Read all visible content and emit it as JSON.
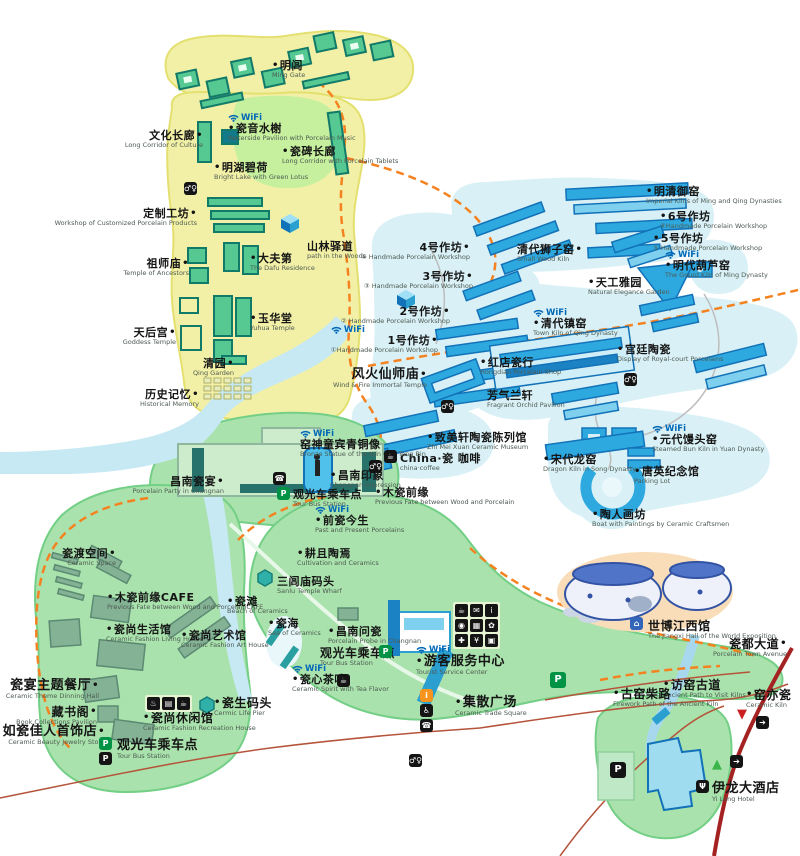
{
  "wifi_text": "WiFi",
  "palette": {
    "yellow_zone": "#f2f0a6",
    "yellow_border": "#e4e070",
    "blue_zone": "#d9f1f6",
    "blue_building": "#2ea9e0",
    "blue_dark": "#1272b8",
    "green_zone": "#a9e2ac",
    "green_border": "#74cf86",
    "sage_building": "#84b295",
    "teal_building": "#56c892",
    "teal_dark": "#127a68",
    "river": "#c6e9f4",
    "orange_path": "#f58220",
    "red_road": "#b5543b",
    "avenue_red": "#a42222",
    "wifi_blue": "#0068b7",
    "label_dark": "#151515"
  },
  "markers": [
    {
      "n": "ming-gate",
      "zh": "明闾",
      "en": "Ming Gate",
      "x": 272,
      "y": 60,
      "d": "l"
    },
    {
      "n": "ciyin-shuixie",
      "zh": "瓷音水榭",
      "en": "Waterside Pavilion with Porcelain Music",
      "x": 228,
      "y": 113,
      "d": "l",
      "w": true
    },
    {
      "n": "wenhua-changlang",
      "zh": "文化长廊",
      "en": "Long Corridor of Culture",
      "x": 203,
      "y": 130,
      "d": "r",
      "a": "r"
    },
    {
      "n": "cibei-changlang",
      "zh": "瓷碑长廊",
      "en": "Long Corridor with Porcelain Tablets",
      "x": 282,
      "y": 146,
      "d": "l"
    },
    {
      "n": "minghu-bihe",
      "zh": "明湖碧荷",
      "en": "Bright Lake with Green Lotus",
      "x": 214,
      "y": 162,
      "d": "l"
    },
    {
      "n": "dingzhi-gongfang",
      "zh": "定制工坊",
      "en": "Workshop of Customized Porcelain Products",
      "x": 197,
      "y": 208,
      "d": "r",
      "a": "r"
    },
    {
      "n": "zushi-miao",
      "zh": "祖师庙",
      "en": "Temple of Ancestors",
      "x": 189,
      "y": 258,
      "d": "r",
      "a": "r"
    },
    {
      "n": "dafu-di",
      "zh": "大夫第",
      "en": "The Dafu Residence",
      "x": 250,
      "y": 253,
      "d": "l"
    },
    {
      "n": "shanlin-yidao",
      "zh": "山林驿道",
      "en": "path in the Woods",
      "x": 307,
      "y": 241
    },
    {
      "n": "yuhua-tang",
      "zh": "玉华堂",
      "en": "Yuhua Temple",
      "x": 250,
      "y": 313,
      "d": "l"
    },
    {
      "n": "tianhou-gong",
      "zh": "天后宫",
      "en": "Goddess Temple",
      "x": 176,
      "y": 327,
      "d": "r",
      "a": "r"
    },
    {
      "n": "qing-yuan",
      "zh": "清园",
      "en": "Qing Garden",
      "x": 234,
      "y": 358,
      "d": "r",
      "a": "r"
    },
    {
      "n": "lishi-jiyi",
      "zh": "历史记忆",
      "en": "Historical Memory",
      "x": 199,
      "y": 389,
      "d": "r",
      "a": "r"
    },
    {
      "n": "mingqing-yuyao",
      "zh": "明清御窑",
      "en": "Imperial Kilns of Ming and Qing Dynasties",
      "x": 646,
      "y": 186,
      "d": "l"
    },
    {
      "n": "workshop-6",
      "zh": "6号作坊",
      "en": "⑥Handmade Porcelain Workshop",
      "x": 660,
      "y": 211,
      "d": "l"
    },
    {
      "n": "workshop-5",
      "zh": "5号作坊",
      "en": "⑤ Handmade Porcelain Workshop",
      "x": 653,
      "y": 233,
      "d": "l"
    },
    {
      "n": "mingdai-huluyao",
      "zh": "明代葫芦窑",
      "en": "The Gourd Kiln of Ming Dynasty",
      "x": 665,
      "y": 250,
      "d": "l",
      "w": true
    },
    {
      "n": "workshop-4",
      "zh": "4号作坊",
      "en": "④ Handmade Porcelain Workshop",
      "x": 470,
      "y": 242,
      "d": "r",
      "a": "r"
    },
    {
      "n": "qingdai-shiziyao",
      "zh": "清代狮子窑",
      "en": "Small Wood Kiln",
      "x": 517,
      "y": 244,
      "d": "r"
    },
    {
      "n": "workshop-3",
      "zh": "3号作坊",
      "en": "③ Handmade Porcelain Workshop",
      "x": 473,
      "y": 271,
      "d": "r",
      "a": "r"
    },
    {
      "n": "tiangong-yayuan",
      "zh": "天工雅园",
      "en": "Natural Elegance Garden",
      "x": 588,
      "y": 277,
      "d": "l"
    },
    {
      "n": "workshop-2",
      "zh": "2号作坊",
      "en": "② Handmade Porcelain Workshop",
      "x": 450,
      "y": 306,
      "d": "r",
      "a": "r"
    },
    {
      "n": "workshop-1",
      "zh": "1号作坊",
      "en": "①Handmade Porcelain Workshop",
      "x": 438,
      "y": 325,
      "d": "r",
      "a": "r",
      "w": true
    },
    {
      "n": "qingdai-zhenyao",
      "zh": "清代镇窑",
      "en": "Town Kiln of Qing Dynasty",
      "x": 533,
      "y": 308,
      "d": "l",
      "w": true
    },
    {
      "n": "hongdian-cihang",
      "zh": "红店瓷行",
      "en": "Hongdian Porcelain Shop",
      "x": 480,
      "y": 357,
      "d": "l"
    },
    {
      "n": "gongting-taoci",
      "zh": "宫廷陶瓷",
      "en": "Display of Royal-court Porcelains",
      "x": 617,
      "y": 344,
      "d": "l"
    },
    {
      "n": "fenghuo-xianshimiao",
      "zh": "风火仙师庙",
      "en": "Wind & Fire Immortal Temple",
      "x": 427,
      "y": 368,
      "d": "r",
      "a": "r",
      "fs": 13
    },
    {
      "n": "fangqi-lanxuan",
      "zh": "芳气兰轩",
      "en": "Fragrant Orchid Pavilion",
      "x": 487,
      "y": 390
    },
    {
      "n": "zhimeixuan-museum",
      "zh": "致美轩陶瓷陈列馆",
      "en": "Zhi Mei Xuan Ceramic Museum",
      "x": 427,
      "y": 432,
      "d": "l"
    },
    {
      "n": "china-coffee",
      "zh": "China·瓷 咖啡",
      "en": "china·coffee",
      "x": 400,
      "y": 453
    },
    {
      "n": "muci-qianyuan",
      "zh": "木瓷前缘",
      "en": "Previous Fate between Wood and Porcelain",
      "x": 375,
      "y": 487,
      "d": "l"
    },
    {
      "n": "yuandai-mantouyao",
      "zh": "元代馒头窑",
      "en": "Steamed Bun Kiln in Yuan Dynasty",
      "x": 652,
      "y": 424,
      "d": "l",
      "w": true
    },
    {
      "n": "songdai-longyao",
      "zh": "宋代龙窑",
      "en": "Dragon Kiln in Song Dynasty",
      "x": 543,
      "y": 454,
      "d": "l"
    },
    {
      "n": "tangying-memorial",
      "zh": "唐英纪念馆",
      "en": "Parking Lot",
      "x": 634,
      "y": 466,
      "d": "l"
    },
    {
      "n": "taoren-huafang",
      "zh": "陶人画坊",
      "en": "Boat with Paintings by Ceramic Craftsmen",
      "x": 592,
      "y": 509,
      "d": "l"
    },
    {
      "n": "kiln-god-statue",
      "zh": "窑神童宾青铜像",
      "en": "Bronze Statue of the Kiln God Tong Bin",
      "x": 300,
      "y": 429,
      "w": true
    },
    {
      "n": "changnan-yinxiang",
      "zh": "昌南印象",
      "en": "Changnan Impression",
      "x": 330,
      "y": 470,
      "d": "l"
    },
    {
      "n": "tour-bus-center",
      "zh": "观光车乘车点",
      "en": "Tour Bus Station",
      "x": 293,
      "y": 489
    },
    {
      "n": "changnan-ciyan",
      "zh": "昌南瓷宴",
      "en": "Porcelain Party in Changnan",
      "x": 224,
      "y": 476,
      "d": "r",
      "a": "r"
    },
    {
      "n": "qianci-jinsheng",
      "zh": "前瓷今生",
      "en": "Past and Present Porcelains",
      "x": 315,
      "y": 505,
      "d": "l",
      "w": true
    },
    {
      "n": "gengqie-taoyan",
      "zh": "耕且陶焉",
      "en": "Cultivation and Ceramics",
      "x": 297,
      "y": 548,
      "d": "l"
    },
    {
      "n": "sanlumiao-wharf",
      "zh": "三闾庙码头",
      "en": "Sanlu Temple Wharf",
      "x": 277,
      "y": 576
    },
    {
      "n": "cidu-kongjian",
      "zh": "瓷渡空间",
      "en": "Ceramic Space",
      "x": 116,
      "y": 548,
      "d": "r",
      "a": "r"
    },
    {
      "n": "muci-cafe",
      "zh": "木瓷前缘CAFE",
      "en": "Previous Fate between Wood and PorcelainCAFE",
      "x": 107,
      "y": 592,
      "d": "l"
    },
    {
      "n": "cishang-living",
      "zh": "瓷尚生活馆",
      "en": "Ceramic Fashion Living House",
      "x": 106,
      "y": 624,
      "d": "l"
    },
    {
      "n": "cishang-art",
      "zh": "瓷尚艺术馆",
      "en": "Ceramic Fashion Art House",
      "x": 181,
      "y": 630,
      "d": "l"
    },
    {
      "n": "citan",
      "zh": "瓷滩",
      "en": "Beach of Ceramics",
      "x": 227,
      "y": 596,
      "d": "l"
    },
    {
      "n": "cihai",
      "zh": "瓷海",
      "en": "Sea of Ceramics",
      "x": 268,
      "y": 618,
      "d": "l"
    },
    {
      "n": "changnan-wenci",
      "zh": "昌南问瓷",
      "en": "Porcelain Probe in Changnan",
      "x": 328,
      "y": 626,
      "d": "l"
    },
    {
      "n": "tour-bus-south",
      "zh": "观光车乘车点",
      "en": "Tour Bus Station",
      "x": 320,
      "y": 647,
      "fs": 12
    },
    {
      "n": "cixin-chawei",
      "zh": "瓷心茶味",
      "en": "Ceramic Spirit with Tea Flavor",
      "x": 292,
      "y": 664,
      "d": "l",
      "w": true
    },
    {
      "n": "tourist-service-center",
      "zh": "游客服务中心",
      "en": "Tourist Service Center",
      "x": 416,
      "y": 645,
      "d": "l",
      "w": true,
      "fs": 13
    },
    {
      "n": "jisan-square",
      "zh": "集散广场",
      "en": "Ceramic Trade Square",
      "x": 455,
      "y": 696,
      "d": "l",
      "fs": 13
    },
    {
      "n": "ciyan-restaurant",
      "zh": "瓷宴主题餐厅",
      "en": "Ceramic Theme Dinning Hall",
      "x": 99,
      "y": 679,
      "d": "r",
      "a": "r",
      "fs": 13
    },
    {
      "n": "cangshu-ge",
      "zh": "藏书阁",
      "en": "Book Collections Pavilion",
      "x": 97,
      "y": 706,
      "d": "r",
      "a": "r",
      "fs": 12
    },
    {
      "n": "ruci-jiaren-jewelry",
      "zh": "如瓷佳人首饰店",
      "en": "Ceramic Beauty Jewelry Store",
      "x": 105,
      "y": 725,
      "d": "r",
      "a": "r",
      "fs": 13
    },
    {
      "n": "tour-bus-west",
      "zh": "观光车乘车点",
      "en": "Tour Bus Station",
      "x": 117,
      "y": 739,
      "fs": 13
    },
    {
      "n": "cishang-recreation",
      "zh": "瓷尚休闲馆",
      "en": "Ceramic Fashion Recreation House",
      "x": 143,
      "y": 712,
      "d": "l",
      "fs": 12
    },
    {
      "n": "cisheng-pier",
      "zh": "瓷生码头",
      "en": "Cermic Life Pier",
      "x": 214,
      "y": 697,
      "d": "l",
      "fs": 12
    },
    {
      "n": "shibo-jiangxi-hall",
      "zh": "世博江西馆",
      "en": "The Jiangxi Hall of the World Exposition",
      "x": 648,
      "y": 620,
      "fs": 12
    },
    {
      "n": "cidu-avenue",
      "zh": "瓷都大道",
      "en": "Porcelain Town Avenue",
      "x": 787,
      "y": 638,
      "d": "r",
      "a": "r",
      "fs": 12
    },
    {
      "n": "fangyao-gudao",
      "zh": "访窑古道",
      "en": "Ancient Path to Visit Kilns",
      "x": 663,
      "y": 679,
      "d": "l",
      "fs": 12
    },
    {
      "n": "guyao-chailu",
      "zh": "古窑柴路",
      "en": "Firework Path of the Ancient Kiln",
      "x": 613,
      "y": 688,
      "d": "l",
      "fs": 12
    },
    {
      "n": "yao-yi-ci",
      "zh": "窑亦瓷",
      "en": "Ceramic Kiln",
      "x": 746,
      "y": 689,
      "d": "l",
      "fs": 12
    },
    {
      "n": "yilong-hotel",
      "zh": "伊龙大酒店",
      "en": "Yi Long Hotel",
      "x": 712,
      "y": 782,
      "fs": 13
    }
  ],
  "icon_defs": {
    "wc": {
      "glyph": "♂♀",
      "bg": "#141414",
      "name": "restroom-icon"
    },
    "parking": {
      "glyph": "P",
      "bg": "#009245",
      "name": "parking-icon"
    },
    "parking-dark": {
      "glyph": "P",
      "bg": "#141414",
      "name": "parking-icon"
    },
    "phone": {
      "glyph": "☎",
      "bg": "#141414",
      "name": "telephone-icon"
    },
    "coffee": {
      "glyph": "☕",
      "bg": "#141414",
      "name": "coffee-icon"
    },
    "tea": {
      "glyph": "☕",
      "bg": "#141414",
      "name": "teahouse-icon"
    },
    "info": {
      "glyph": "i",
      "bg": "#f7941d",
      "name": "information-icon"
    },
    "access": {
      "glyph": "♿",
      "bg": "#141414",
      "name": "accessibility-icon"
    },
    "exit": {
      "glyph": "➔",
      "bg": "#141414",
      "name": "exit-icon"
    },
    "restaurant": {
      "glyph": "Ψ",
      "bg": "#141414",
      "name": "restaurant-icon"
    },
    "hall": {
      "glyph": "⌂",
      "bg": "#3366bb",
      "name": "jiangxi-hall-icon"
    },
    "tri-red": {
      "glyph": "▼",
      "bg": "none",
      "fg": "#cc1f1f",
      "name": "entrance-marker-red"
    },
    "tri-green": {
      "glyph": "▲",
      "bg": "none",
      "fg": "#39b54a",
      "name": "entrance-marker-green"
    }
  },
  "icons": [
    {
      "t": "wc",
      "x": 184,
      "y": 182
    },
    {
      "t": "wc",
      "x": 441,
      "y": 400
    },
    {
      "t": "wc",
      "x": 624,
      "y": 373
    },
    {
      "t": "wc",
      "x": 369,
      "y": 460
    },
    {
      "t": "wc",
      "x": 409,
      "y": 754
    },
    {
      "t": "coffee",
      "x": 384,
      "y": 450
    },
    {
      "t": "tea",
      "x": 337,
      "y": 674
    },
    {
      "t": "phone",
      "x": 273,
      "y": 472
    },
    {
      "t": "phone",
      "x": 420,
      "y": 719
    },
    {
      "t": "info",
      "x": 420,
      "y": 689
    },
    {
      "t": "access",
      "x": 420,
      "y": 704
    },
    {
      "t": "parking",
      "x": 277,
      "y": 487
    },
    {
      "t": "parking",
      "x": 379,
      "y": 645
    },
    {
      "t": "parking",
      "x": 550,
      "y": 672,
      "s": "big"
    },
    {
      "t": "parking",
      "x": 99,
      "y": 737
    },
    {
      "t": "parking-dark",
      "x": 99,
      "y": 752
    },
    {
      "t": "parking-dark",
      "x": 610,
      "y": 762,
      "s": "big"
    },
    {
      "t": "exit",
      "x": 756,
      "y": 716
    },
    {
      "t": "exit",
      "x": 730,
      "y": 755
    },
    {
      "t": "tri-red",
      "x": 737,
      "y": 708
    },
    {
      "t": "tri-green",
      "x": 712,
      "y": 758
    },
    {
      "t": "restaurant",
      "x": 696,
      "y": 780
    },
    {
      "t": "hall",
      "x": 630,
      "y": 617
    }
  ],
  "service_center": {
    "x": 453,
    "y": 602,
    "items": [
      {
        "n": "food-service",
        "g": "☕"
      },
      {
        "n": "mail-service",
        "g": "✉"
      },
      {
        "n": "information",
        "g": "i"
      },
      {
        "n": "photo-service",
        "g": "◉"
      },
      {
        "n": "ticket-service",
        "g": "▦"
      },
      {
        "n": "gift-shop",
        "g": "✿"
      },
      {
        "n": "first-aid",
        "g": "✚"
      },
      {
        "n": "currency-exchange",
        "g": "¥"
      },
      {
        "n": "internet-service",
        "g": "▣"
      }
    ]
  },
  "spa_row": {
    "x": 145,
    "y": 695,
    "items": [
      {
        "n": "massage",
        "g": "♨"
      },
      {
        "n": "lounge",
        "g": "▤"
      },
      {
        "n": "tea-service",
        "g": "☕"
      }
    ]
  }
}
